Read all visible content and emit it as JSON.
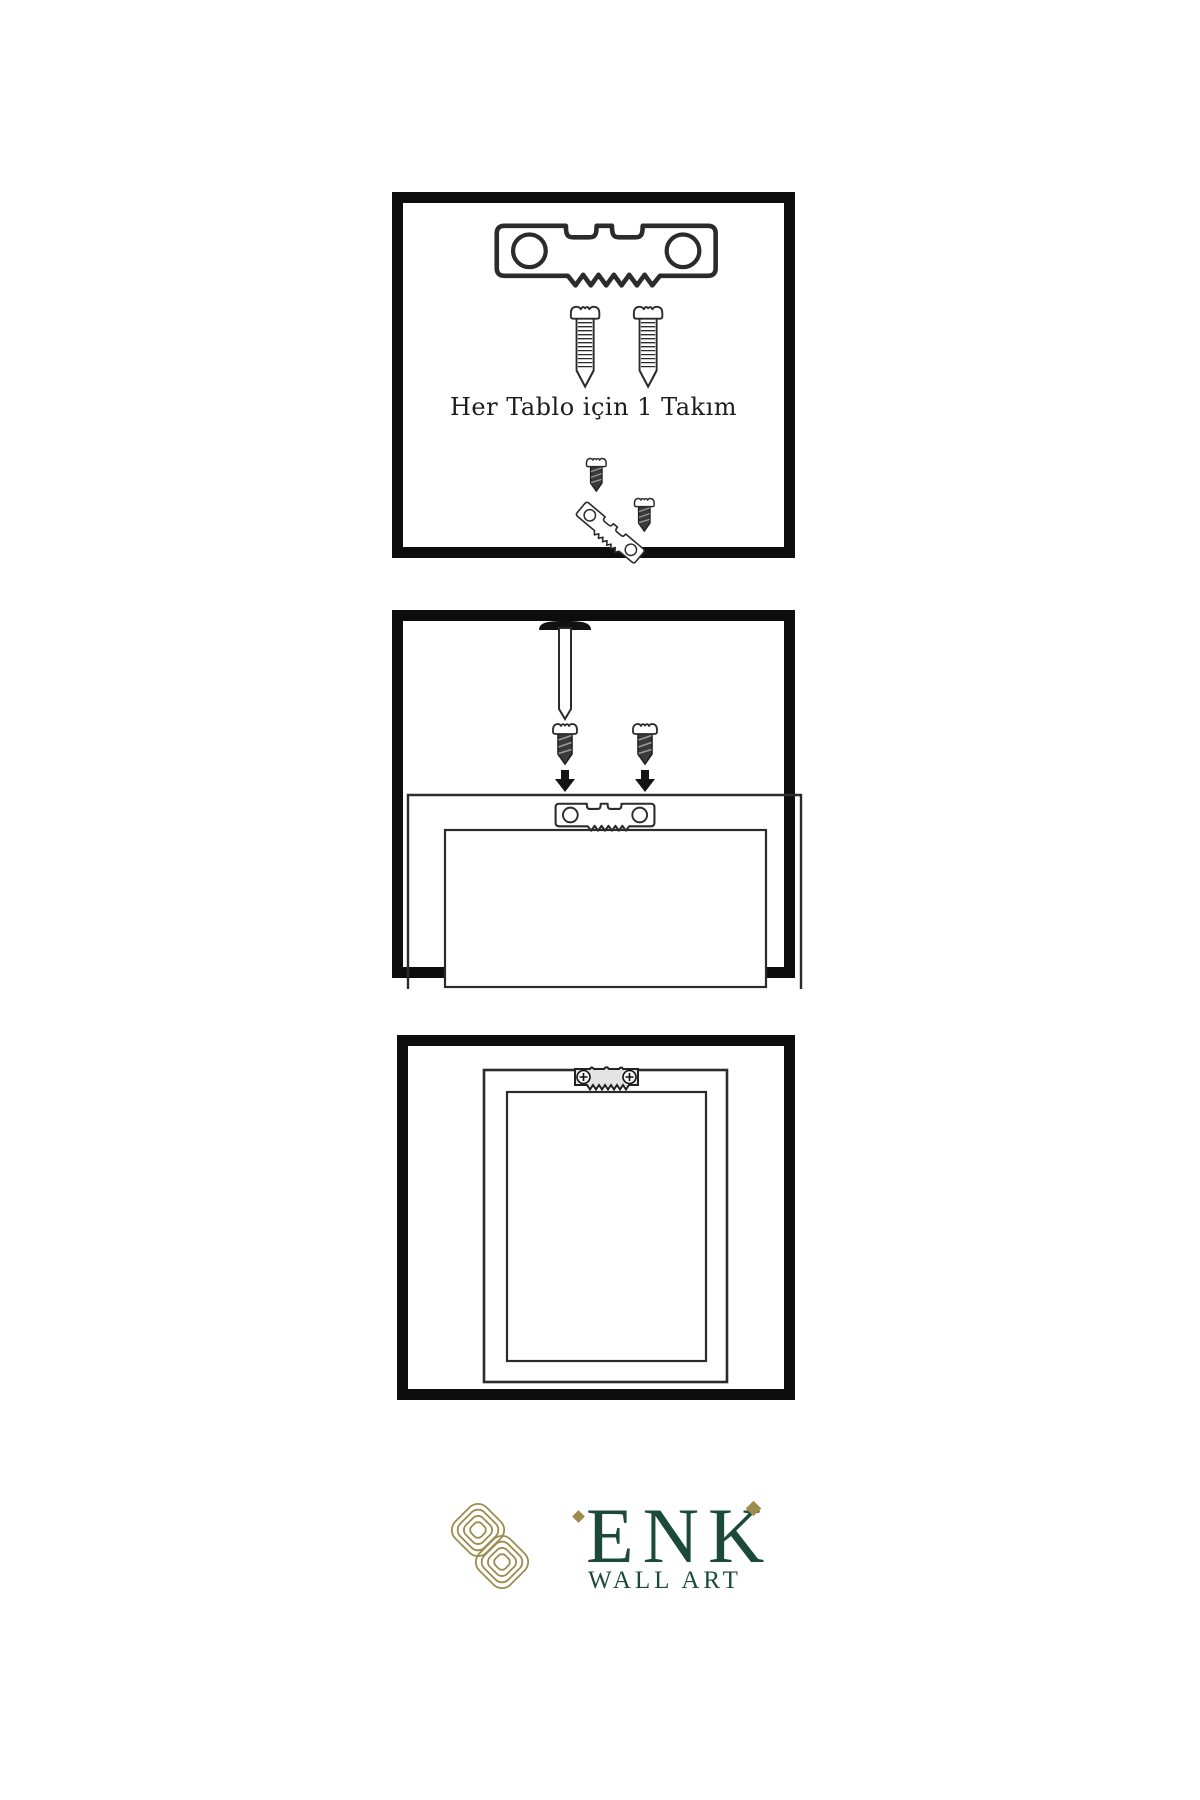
{
  "canvas": {
    "width": 1200,
    "height": 1800,
    "background": "#ffffff"
  },
  "style": {
    "panel_border_color": "#0d0d0d",
    "line_color": "#2b2b2b",
    "dark_screw_fill": "#3a3a3a",
    "hanger_plate_fill": "#e4e4e4"
  },
  "steps": [
    {
      "id": "hardware-kit",
      "caption": "Her Tablo için 1 Takım",
      "icons": [
        "sawtooth-hanger-icon",
        "screw-icon",
        "screw-icon",
        "dark-screw-icon",
        "tilted-sawtooth-hanger-icon",
        "dark-screw-icon"
      ]
    },
    {
      "id": "attach-hanger-to-frame-back",
      "icons": [
        "wall-nail-icon",
        "dark-screw-icon",
        "dark-screw-icon",
        "down-arrow-icon",
        "down-arrow-icon",
        "sawtooth-hanger-icon",
        "frame-back-icon"
      ]
    },
    {
      "id": "hang-frame-on-wall",
      "icons": [
        "mounted-sawtooth-hanger-icon",
        "frame-front-icon"
      ]
    }
  ],
  "brand": {
    "name": "ENK",
    "subtitle": "WALL ART",
    "text_color": "#1b4a3a",
    "logo_color": "#9c8c4e",
    "logo_icon": "interlocked-knot-icon"
  }
}
